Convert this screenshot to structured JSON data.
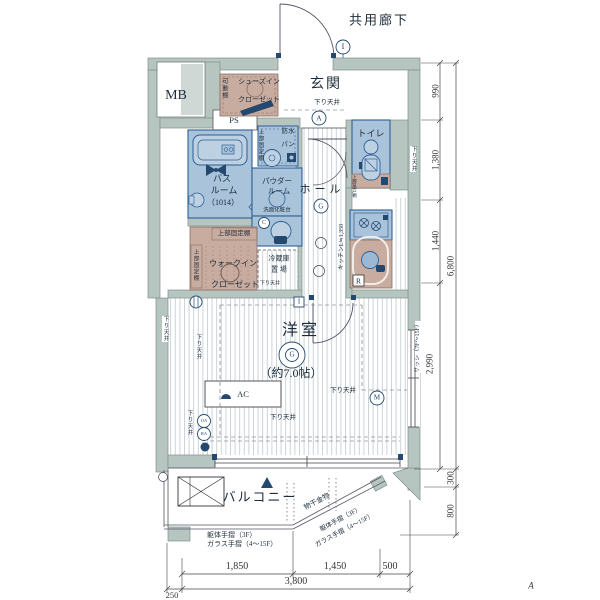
{
  "labels": {
    "corridor": "共用廊下",
    "mb": "MB",
    "ps": "PS",
    "genkan": "玄関",
    "down_genkan": "下り天井",
    "sic1": "シューズイン",
    "sic2": "クローゼット",
    "sic_shelf": "可動棚",
    "bousui1": "防水",
    "bousui2": "パン",
    "shelf_bousui": "上部固定棚",
    "bath1": "バス",
    "bath2": "ルーム",
    "bath3": "（1014）",
    "powder1": "パウダー",
    "powder2": "ルーム",
    "vanity": "洗面化粧台",
    "toilet": "トイレ",
    "down_toilet": "下り天井",
    "cupboard": "上部吊戸棚",
    "hall": "ホール",
    "kitchen_note": "キッチンL≒1,350",
    "r_mark": "R",
    "wic_shelf_top": "上部固定棚",
    "wic_shelf_left": "上部固定棚",
    "wic1": "ウォークイン",
    "wic2": "クローゼット",
    "fridge1": "冷蔵庫",
    "fridge2": "置 場",
    "down_fridge": "下り天井",
    "room": "洋室",
    "room_size": "（約7.0帖）",
    "ac": "AC",
    "down_room_r": "下り天井",
    "down_room_b": "下り天井",
    "down_left1": "下り天井",
    "down_left2": "下り天井",
    "down_left3": "下り天井",
    "sash": "サッシ（7F～15F）",
    "balcony": "バルコニー",
    "monohoshi": "物干金物",
    "rail_d1": "躯体手摺（3F）",
    "rail_d2": "ガラス手摺（4～15F）",
    "rail_h1": "躯体手摺（3F）",
    "rail_h2": "ガラス手摺（4～15F）"
  },
  "symbols": {
    "i_top": "I",
    "a": "A",
    "g_hall": "G",
    "g_room": "G",
    "i_box": "I",
    "m": "M",
    "c": "C",
    "oa": "OA",
    "ra": "RA"
  },
  "dims": {
    "r990": "990",
    "r1380": "1,380",
    "r1440": "1,440",
    "r6800": "6,800",
    "r2990": "2,990",
    "r300": "300",
    "r800": "800",
    "b1850": "1,850",
    "b1450": "1,450",
    "b500": "500",
    "b3800": "3,800",
    "b250": "250"
  },
  "section_mark": "A",
  "colors": {
    "wall": "#b7c5c0",
    "wet_room_blue": "#a9c3da",
    "closet_pink": "#c9aca0",
    "fixture_navy": "#24486e"
  }
}
